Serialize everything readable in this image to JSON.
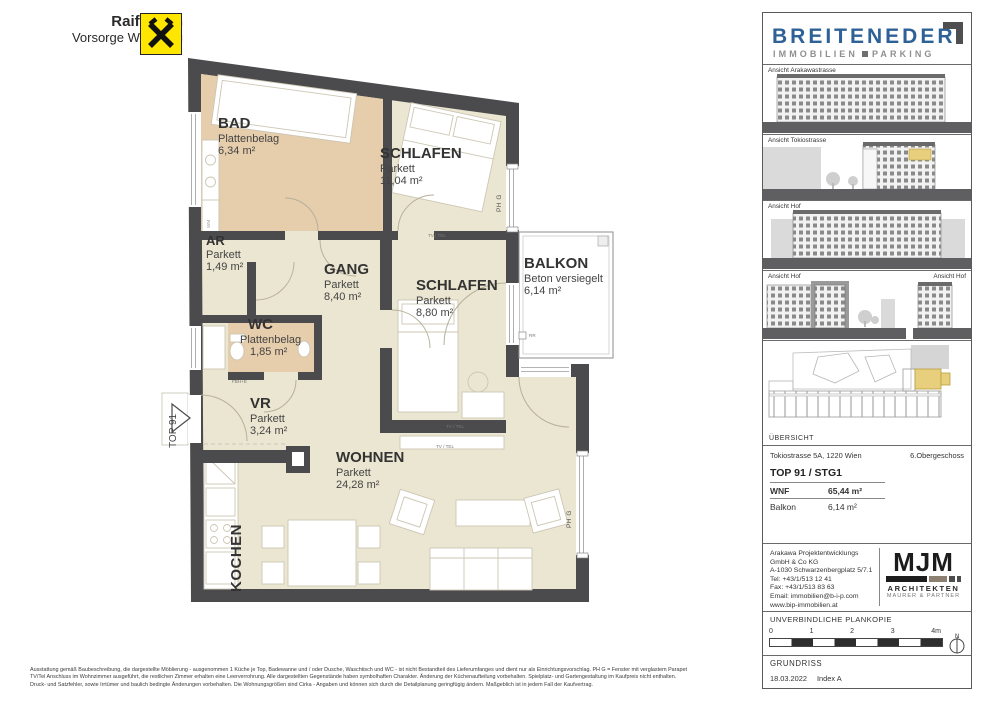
{
  "logo_raiffeisen": {
    "line1": "Raiffeisen",
    "line2": "Vorsorge Wohnung"
  },
  "plan": {
    "rooms": {
      "bad": {
        "name": "BAD",
        "floor": "Plattenbelag",
        "area": "6,34 m²"
      },
      "schlafen1": {
        "name": "SCHLAFEN",
        "floor": "Parkett",
        "area": "11,04 m²"
      },
      "ar": {
        "name": "AR",
        "floor": "Parkett",
        "area": "1,49 m²"
      },
      "gang": {
        "name": "GANG",
        "floor": "Parkett",
        "area": "8,40 m²"
      },
      "schlafen2": {
        "name": "SCHLAFEN",
        "floor": "Parkett",
        "area": "8,80 m²"
      },
      "balkon": {
        "name": "BALKON",
        "floor": "Beton versiegelt",
        "area": "6,14 m²"
      },
      "wc": {
        "name": "WC",
        "floor": "Plattenbelag",
        "area": "1,85 m²"
      },
      "vr": {
        "name": "VR",
        "floor": "Parkett",
        "area": "3,24 m²"
      },
      "wohnen": {
        "name": "WOHNEN",
        "floor": "Parkett",
        "area": "24,28 m²"
      },
      "kochen": {
        "name": "KOCHEN"
      }
    },
    "annotations": {
      "unit": "TOP 91",
      "wm": "WM",
      "phg": "PH G",
      "tv_tel_pipe": "TV | TEL",
      "tv_tel": "TV / TEL",
      "fbhe": "FBH+E",
      "rr": "RR"
    }
  },
  "sidebar": {
    "brand": {
      "name": "BREITENEDER",
      "sub_left": "IMMOBILIEN",
      "sub_right": "PARKING"
    },
    "elevations": [
      {
        "label": "Ansicht Arakawastrasse"
      },
      {
        "label": "Ansicht Tokiostrasse"
      },
      {
        "label": "Ansicht Hof"
      },
      {
        "label": "Ansicht Hof",
        "label2": "Ansicht Hof"
      }
    ],
    "overview_label": "ÜBERSICHT",
    "address_line": "Tokiostrasse 5A, 1220 Wien",
    "floor": "6.Obergeschoss",
    "unit_title": "TOP 91 / STG1",
    "metrics": {
      "wnf_label": "WNF",
      "wnf_value": "65,44 m²",
      "balkon_label": "Balkon",
      "balkon_value": "6,14 m²"
    },
    "contact": {
      "lines": [
        "Arakawa Projektentwicklungs",
        "GmbH & Co KG",
        "A-1030 Schwarzenbergplatz 5/7.1",
        "Tel: +43/1/513 12 41",
        "Fax: +43/1/513 83 63",
        "Email: immobilien@b-i-p.com",
        "www.bip-immobilien.at"
      ]
    },
    "architect": {
      "name": "MJM",
      "line1": "ARCHITEKTEN",
      "line2": "MAURER & PARTNER"
    },
    "plankopie": "UNVERBINDLICHE PLANKOPIE",
    "scale": {
      "t0": "0",
      "t1": "1",
      "t2": "2",
      "t3": "3",
      "t4": "4m",
      "north": "N"
    },
    "plan_type": "GRUNDRISS",
    "date": "18.03.2022",
    "index": "Index A"
  },
  "footer": {
    "line1": "Ausstattung gemäß Baubeschreibung, die dargestellte Möblierung - ausgenommen 1 Küche je Top, Badewanne und / oder Dusche, Waschtisch und WC - ist nicht Bestandteil des Lieferumfanges und dient nur als Einrichtungsvorschlag. PH G = Fenster mit verglastem Parapet",
    "line2": "TV/Tel Anschluss im Wohnzimmer ausgeführt, die restlichen Zimmer erhalten eine Leerverrohrung. Alle dargestellten Gegenstände haben symbolhaften Charakter. Änderung der Küchenaufteilung vorbehalten. Spielplatz- und Gartengestaltung im Kaufpreis nicht enthalten.",
    "line3": "Druck- und Satzfehler, sowie Irrtümer und baulich bedingte Änderungen vorbehalten. Die Wohnungsgrößen sind Cirka - Angaben und können sich durch die Detailplanung geringfügig ändern. Maßgeblich ist in jedem Fall der Kaufvertrag."
  }
}
